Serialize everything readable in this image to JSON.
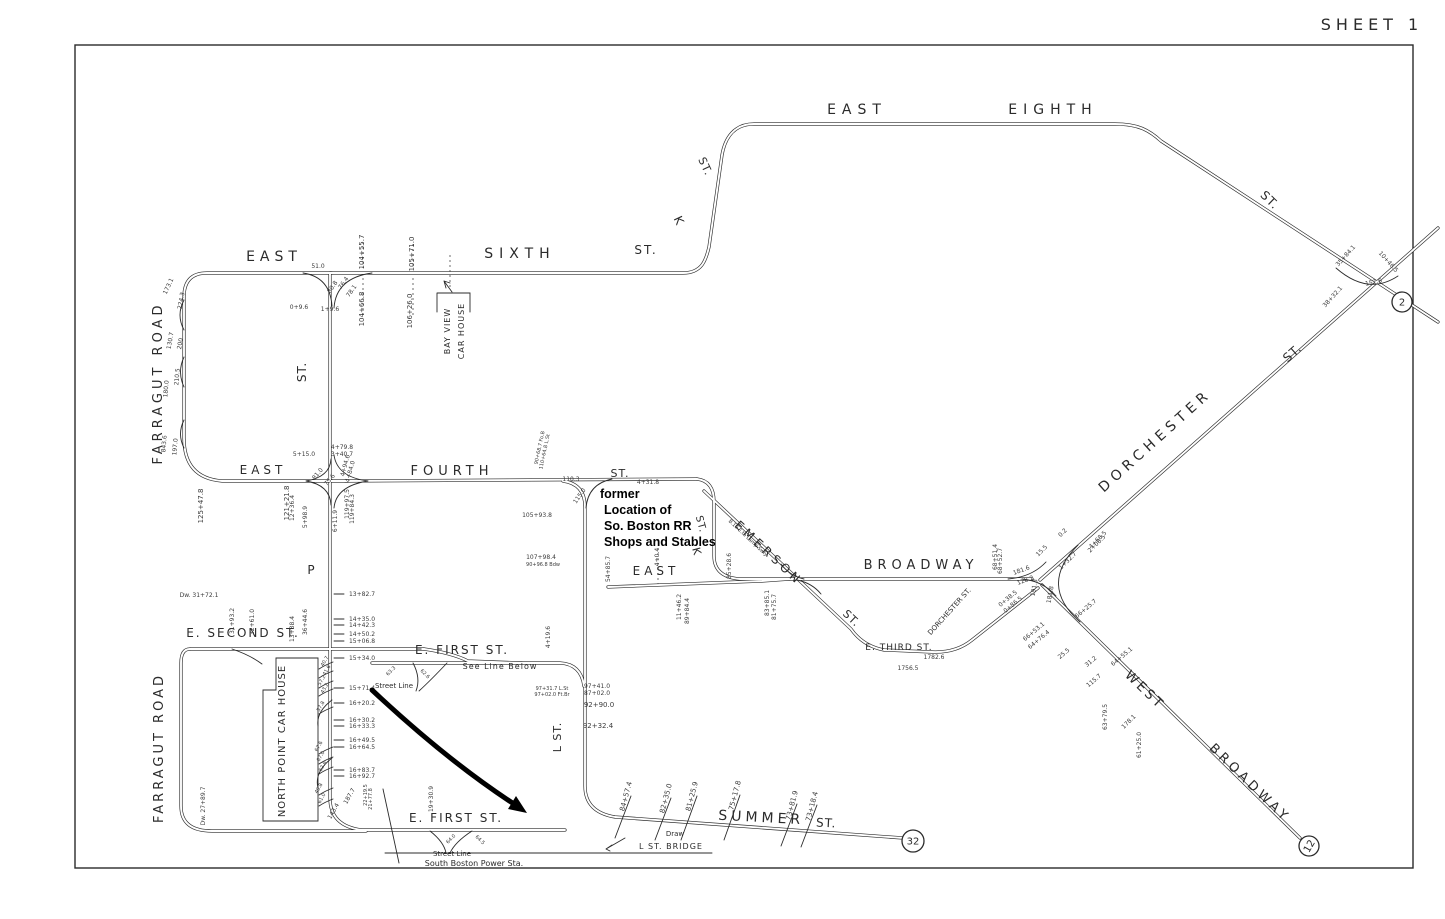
{
  "sheet": {
    "title": "SHEET 1"
  },
  "colors": {
    "ink": "#2b2b2b",
    "paper": "#ffffff",
    "annotation": "#000000"
  },
  "annotation": {
    "note_lines": [
      "former",
      "Location of",
      "So. Boston RR",
      "Shops and Stables"
    ]
  },
  "markers": [
    {
      "text": "2",
      "x": 1402,
      "y": 302,
      "r": 10
    },
    {
      "text": "32",
      "x": 913,
      "y": 841,
      "r": 11
    },
    {
      "text": "12",
      "x": 1309,
      "y": 846,
      "r": 10,
      "rot": -60
    }
  ],
  "street_labels": [
    {
      "text": "EAST",
      "x": 274,
      "y": 261,
      "rot": 0,
      "fs": 14,
      "ls": 5
    },
    {
      "text": "SIXTH",
      "x": 520,
      "y": 258,
      "rot": 0,
      "fs": 14,
      "ls": 6
    },
    {
      "text": "ST.",
      "x": 646,
      "y": 254,
      "rot": 0,
      "fs": 12,
      "ls": 2
    },
    {
      "text": "K",
      "x": 675,
      "y": 222,
      "rot": 65,
      "fs": 12,
      "ls": 0
    },
    {
      "text": "ST.",
      "x": 702,
      "y": 168,
      "rot": 65,
      "fs": 11,
      "ls": 1
    },
    {
      "text": "EAST",
      "x": 857,
      "y": 114,
      "rot": 0,
      "fs": 14,
      "ls": 6
    },
    {
      "text": "EIGHTH",
      "x": 1053,
      "y": 114,
      "rot": 0,
      "fs": 14,
      "ls": 6
    },
    {
      "text": "ST.",
      "x": 1267,
      "y": 203,
      "rot": 44,
      "fs": 12,
      "ls": 1
    },
    {
      "text": "DORCHESTER",
      "x": 1158,
      "y": 444,
      "rot": -42,
      "fs": 14,
      "ls": 5
    },
    {
      "text": "ST.",
      "x": 1295,
      "y": 356,
      "rot": -42,
      "fs": 12,
      "ls": 1
    },
    {
      "text": "BROADWAY",
      "x": 921,
      "y": 569,
      "rot": 0,
      "fs": 13,
      "ls": 5
    },
    {
      "text": "EAST",
      "x": 656,
      "y": 575,
      "rot": 0,
      "fs": 12,
      "ls": 4
    },
    {
      "text": "EMERSON",
      "x": 766,
      "y": 556,
      "rot": 43,
      "fs": 12,
      "ls": 4
    },
    {
      "text": "ST.",
      "x": 849,
      "y": 621,
      "rot": 43,
      "fs": 11,
      "ls": 1
    },
    {
      "text": "E. THIRD ST.",
      "x": 899,
      "y": 650,
      "rot": 0,
      "fs": 9,
      "ls": 1
    },
    {
      "text": "DORCHESTER ST.",
      "x": 951,
      "y": 613,
      "rot": -48,
      "fs": 7,
      "ls": 0
    },
    {
      "text": "WEST",
      "x": 1142,
      "y": 693,
      "rot": 44,
      "fs": 13,
      "ls": 3
    },
    {
      "text": "BROADWAY",
      "x": 1247,
      "y": 786,
      "rot": 44,
      "fs": 13,
      "ls": 4
    },
    {
      "text": "FOURTH",
      "x": 452,
      "y": 475,
      "rot": 0,
      "fs": 13,
      "ls": 5
    },
    {
      "text": "ST.",
      "x": 620,
      "y": 477,
      "rot": 0,
      "fs": 11,
      "ls": 1
    },
    {
      "text": "EAST",
      "x": 263,
      "y": 474,
      "rot": 0,
      "fs": 12,
      "ls": 4
    },
    {
      "text": "P",
      "x": 311,
      "y": 574,
      "rot": 0,
      "fs": 12,
      "ls": 0
    },
    {
      "text": "ST.",
      "x": 306,
      "y": 372,
      "rot": -90,
      "fs": 12,
      "ls": 1
    },
    {
      "text": "FARRAGUT ROAD",
      "x": 162,
      "y": 383,
      "rot": -90,
      "fs": 13,
      "ls": 4
    },
    {
      "text": "E. SECOND ST.",
      "x": 243,
      "y": 637,
      "rot": 0,
      "fs": 12,
      "ls": 2
    },
    {
      "text": "FARRAGUT ROAD",
      "x": 163,
      "y": 748,
      "rot": -90,
      "fs": 13,
      "ls": 3
    },
    {
      "text": "NORTH POINT CAR HOUSE",
      "x": 285,
      "y": 741,
      "rot": -90,
      "fs": 10,
      "ls": 1
    },
    {
      "text": "E. FIRST ST.",
      "x": 462,
      "y": 654,
      "rot": 0,
      "fs": 12,
      "ls": 2
    },
    {
      "text": "See Line Below",
      "x": 500,
      "y": 669,
      "rot": 0,
      "fs": 8,
      "ls": 1
    },
    {
      "text": "Street Line",
      "x": 394,
      "y": 688,
      "rot": 0,
      "fs": 7,
      "ls": 0
    },
    {
      "text": "L ST.",
      "x": 561,
      "y": 737,
      "rot": -90,
      "fs": 11,
      "ls": 1
    },
    {
      "text": "E. FIRST ST.",
      "x": 456,
      "y": 822,
      "rot": 0,
      "fs": 12,
      "ls": 2
    },
    {
      "text": "Street Line",
      "x": 452,
      "y": 856,
      "rot": 0,
      "fs": 7,
      "ls": 0
    },
    {
      "text": "South Boston Power Sta.",
      "x": 474,
      "y": 866,
      "rot": 0,
      "fs": 8,
      "ls": 0
    },
    {
      "text": "SUMMER",
      "x": 761,
      "y": 822,
      "rot": 3,
      "fs": 14,
      "ls": 4
    },
    {
      "text": "ST.",
      "x": 826,
      "y": 827,
      "rot": 3,
      "fs": 12,
      "ls": 1
    },
    {
      "text": "Draw",
      "x": 675,
      "y": 836,
      "rot": 0,
      "fs": 7,
      "ls": 0
    },
    {
      "text": "L ST. BRIDGE",
      "x": 671,
      "y": 849,
      "rot": 0,
      "fs": 8,
      "ls": 1
    },
    {
      "text": "BAY VIEW",
      "x": 450,
      "y": 331,
      "rot": -90,
      "fs": 8,
      "ls": 1
    },
    {
      "text": "CAR HOUSE",
      "x": 464,
      "y": 331,
      "rot": -90,
      "fs": 8,
      "ls": 1
    },
    {
      "text": "K",
      "x": 693,
      "y": 552,
      "rot": 75,
      "fs": 11,
      "ls": 0
    },
    {
      "text": "ST.",
      "x": 698,
      "y": 525,
      "rot": 75,
      "fs": 10,
      "ls": 1
    },
    {
      "text": "B.19 E.to Lamp Swly",
      "x": 747,
      "y": 539,
      "rot": 43,
      "fs": 5,
      "ls": 0
    }
  ],
  "measurements": [
    {
      "text": "51.0",
      "x": 318,
      "y": 268,
      "rot": 0,
      "fs": 6
    },
    {
      "text": "104+55.7",
      "x": 364,
      "y": 252,
      "rot": -90
    },
    {
      "text": "105+71.0",
      "x": 414,
      "y": 254,
      "rot": -90
    },
    {
      "text": "104+66.8",
      "x": 364,
      "y": 309,
      "rot": -90
    },
    {
      "text": "106+26.0",
      "x": 412,
      "y": 311,
      "rot": -90
    },
    {
      "text": "0+9.6",
      "x": 299,
      "y": 309,
      "rot": 0,
      "fs": 6
    },
    {
      "text": "1+9.6",
      "x": 330,
      "y": 311,
      "rot": 0,
      "fs": 6
    },
    {
      "text": "80.8",
      "x": 334,
      "y": 288,
      "rot": -55,
      "fs": 6
    },
    {
      "text": "76.4",
      "x": 345,
      "y": 284,
      "rot": -55,
      "fs": 6
    },
    {
      "text": "78.1",
      "x": 353,
      "y": 292,
      "rot": -55,
      "fs": 6
    },
    {
      "text": "173.1",
      "x": 170,
      "y": 287,
      "rot": -65,
      "fs": 6
    },
    {
      "text": "224.3",
      "x": 183,
      "y": 301,
      "rot": -80,
      "fs": 6
    },
    {
      "text": "130.7",
      "x": 172,
      "y": 341,
      "rot": -80,
      "fs": 6
    },
    {
      "text": "200",
      "x": 182,
      "y": 344,
      "rot": -80,
      "fs": 6
    },
    {
      "text": "210.5",
      "x": 179,
      "y": 377,
      "rot": -85,
      "fs": 6
    },
    {
      "text": "180.0",
      "x": 168,
      "y": 389,
      "rot": -85,
      "fs": 6
    },
    {
      "text": "843.6",
      "x": 166,
      "y": 444,
      "rot": -85,
      "fs": 6
    },
    {
      "text": "197.0",
      "x": 177,
      "y": 447,
      "rot": -85,
      "fs": 6
    },
    {
      "text": "125+47.8",
      "x": 203,
      "y": 506,
      "rot": -90
    },
    {
      "text": "5+15.0",
      "x": 304,
      "y": 456,
      "rot": 0,
      "fs": 6
    },
    {
      "text": "4+79.8",
      "x": 342,
      "y": 449,
      "rot": 0,
      "fs": 6
    },
    {
      "text": "3+40.7",
      "x": 342,
      "y": 456,
      "rot": 0,
      "fs": 6
    },
    {
      "text": "81.0",
      "x": 319,
      "y": 475,
      "rot": -50,
      "fs": 6
    },
    {
      "text": "75.6",
      "x": 331,
      "y": 481,
      "rot": -50,
      "fs": 6
    },
    {
      "text": "4+94.6",
      "x": 347,
      "y": 466,
      "rot": -75,
      "fs": 6
    },
    {
      "text": "4+84.0",
      "x": 352,
      "y": 472,
      "rot": -75,
      "fs": 6
    },
    {
      "text": "121+21.8",
      "x": 289,
      "y": 503,
      "rot": -90
    },
    {
      "text": "12+36.4",
      "x": 294,
      "y": 508,
      "rot": -90,
      "fs": 6
    },
    {
      "text": "5+98.9",
      "x": 307,
      "y": 517,
      "rot": -90,
      "fs": 6
    },
    {
      "text": "6+11.9",
      "x": 337,
      "y": 521,
      "rot": -90,
      "fs": 6
    },
    {
      "text": "119+97.5",
      "x": 349,
      "y": 504,
      "rot": -90,
      "fs": 6
    },
    {
      "text": "119+84.3",
      "x": 354,
      "y": 509,
      "rot": -90,
      "fs": 6
    },
    {
      "text": "90+68.7 Fo.B",
      "x": 541,
      "y": 448,
      "rot": -78,
      "fs": 5
    },
    {
      "text": "110+64.8 L.St",
      "x": 546,
      "y": 452,
      "rot": -78,
      "fs": 5
    },
    {
      "text": "110.3",
      "x": 571,
      "y": 481,
      "rot": 0,
      "fs": 6
    },
    {
      "text": "4+31.8",
      "x": 648,
      "y": 484,
      "rot": 0,
      "fs": 6
    },
    {
      "text": "115.0",
      "x": 581,
      "y": 497,
      "rot": -55,
      "fs": 6
    },
    {
      "text": "105+93.8",
      "x": 537,
      "y": 517,
      "rot": 0,
      "fs": 6
    },
    {
      "text": "107+98.4",
      "x": 541,
      "y": 559,
      "rot": 0,
      "fs": 6
    },
    {
      "text": "90+96.8 Bdw",
      "x": 543,
      "y": 566,
      "rot": 0,
      "fs": 5
    },
    {
      "text": "54+85.7",
      "x": 610,
      "y": 569,
      "rot": -90,
      "fs": 6
    },
    {
      "text": "4+0.4",
      "x": 659,
      "y": 557,
      "rot": -90,
      "fs": 6
    },
    {
      "text": "85+28.6",
      "x": 731,
      "y": 566,
      "rot": -90,
      "fs": 6
    },
    {
      "text": "11+46.2",
      "x": 681,
      "y": 607,
      "rot": -90,
      "fs": 6
    },
    {
      "text": "89+84.4",
      "x": 689,
      "y": 611,
      "rot": -90,
      "fs": 6
    },
    {
      "text": "83+85.1",
      "x": 769,
      "y": 603,
      "rot": -90,
      "fs": 6
    },
    {
      "text": "81+75.7",
      "x": 776,
      "y": 607,
      "rot": -90,
      "fs": 6
    },
    {
      "text": "68+51.4",
      "x": 997,
      "y": 557,
      "rot": -90,
      "fs": 6
    },
    {
      "text": "68+52.7",
      "x": 1002,
      "y": 561,
      "rot": -90,
      "fs": 6
    },
    {
      "text": "181.6",
      "x": 1022,
      "y": 572,
      "rot": -20,
      "fs": 6
    },
    {
      "text": "128.2",
      "x": 1026,
      "y": 582,
      "rot": -20,
      "fs": 6
    },
    {
      "text": "191.3",
      "x": 1036,
      "y": 588,
      "rot": -80,
      "fs": 6
    },
    {
      "text": "181.8",
      "x": 1052,
      "y": 595,
      "rot": -80,
      "fs": 6
    },
    {
      "text": "0.2",
      "x": 1064,
      "y": 534,
      "rot": -45,
      "fs": 6
    },
    {
      "text": "1+32.7",
      "x": 1069,
      "y": 562,
      "rot": -45,
      "fs": 6
    },
    {
      "text": "2+08.5",
      "x": 1098,
      "y": 545,
      "rot": -45,
      "fs": 6
    },
    {
      "text": "15.5",
      "x": 1043,
      "y": 552,
      "rot": -45,
      "fs": 6
    },
    {
      "text": "4+68.5",
      "x": 1099,
      "y": 541,
      "rot": -45,
      "fs": 6
    },
    {
      "text": "0+38.5",
      "x": 1009,
      "y": 600,
      "rot": -40,
      "fs": 6
    },
    {
      "text": "0+86.5",
      "x": 1014,
      "y": 606,
      "rot": -40,
      "fs": 6
    },
    {
      "text": "66+25.7",
      "x": 1087,
      "y": 610,
      "rot": -40,
      "fs": 6
    },
    {
      "text": "66+53.1",
      "x": 1035,
      "y": 633,
      "rot": -40,
      "fs": 6
    },
    {
      "text": "64+76.4",
      "x": 1040,
      "y": 641,
      "rot": -40,
      "fs": 6
    },
    {
      "text": "64+55.1",
      "x": 1123,
      "y": 658,
      "rot": -40,
      "fs": 6
    },
    {
      "text": "25.5",
      "x": 1065,
      "y": 655,
      "rot": -40,
      "fs": 6
    },
    {
      "text": "31.2",
      "x": 1092,
      "y": 663,
      "rot": -40,
      "fs": 6
    },
    {
      "text": "115.7",
      "x": 1095,
      "y": 682,
      "rot": -40,
      "fs": 6
    },
    {
      "text": "63+79.5",
      "x": 1107,
      "y": 717,
      "rot": -90,
      "fs": 6
    },
    {
      "text": "178.1",
      "x": 1130,
      "y": 723,
      "rot": -45,
      "fs": 6
    },
    {
      "text": "61+25.0",
      "x": 1141,
      "y": 745,
      "rot": -90,
      "fs": 6
    },
    {
      "text": "35+84.1",
      "x": 1347,
      "y": 257,
      "rot": -48,
      "fs": 6
    },
    {
      "text": "10+46.5",
      "x": 1387,
      "y": 263,
      "rot": 48,
      "fs": 6
    },
    {
      "text": "152.6",
      "x": 1374,
      "y": 284,
      "rot": -12,
      "fs": 6
    },
    {
      "text": "38+32.1",
      "x": 1334,
      "y": 298,
      "rot": -48,
      "fs": 6
    },
    {
      "text": "1782.6",
      "x": 934,
      "y": 659,
      "rot": 0,
      "fs": 6
    },
    {
      "text": "1756.5",
      "x": 908,
      "y": 670,
      "rot": 0,
      "fs": 6
    },
    {
      "text": "Dw. 31+72.1",
      "x": 199,
      "y": 597,
      "rot": 0,
      "fs": 6
    },
    {
      "text": "31+93.2",
      "x": 234,
      "y": 621,
      "rot": -90,
      "fs": 6
    },
    {
      "text": "32+61.0",
      "x": 254,
      "y": 622,
      "rot": -90,
      "fs": 6
    },
    {
      "text": "13+38.4",
      "x": 294,
      "y": 629,
      "rot": -90,
      "fs": 6
    },
    {
      "text": "36+44.6",
      "x": 307,
      "y": 622,
      "rot": -90,
      "fs": 6
    },
    {
      "text": "13+82.7",
      "x": 362,
      "y": 596,
      "rot": 0,
      "fs": 6
    },
    {
      "text": "14+35.0",
      "x": 362,
      "y": 621,
      "rot": 0,
      "fs": 6
    },
    {
      "text": "14+42.3",
      "x": 362,
      "y": 627,
      "rot": 0,
      "fs": 6
    },
    {
      "text": "14+50.2",
      "x": 362,
      "y": 636,
      "rot": 0,
      "fs": 6
    },
    {
      "text": "15+06.8",
      "x": 362,
      "y": 643,
      "rot": 0,
      "fs": 6
    },
    {
      "text": "15+34.0",
      "x": 362,
      "y": 660,
      "rot": 0,
      "fs": 6
    },
    {
      "text": "15+71.4",
      "x": 362,
      "y": 690,
      "rot": 0,
      "fs": 6
    },
    {
      "text": "16+20.2",
      "x": 362,
      "y": 705,
      "rot": 0,
      "fs": 6
    },
    {
      "text": "16+30.2",
      "x": 362,
      "y": 722,
      "rot": 0,
      "fs": 6
    },
    {
      "text": "16+33.3",
      "x": 362,
      "y": 728,
      "rot": 0,
      "fs": 6
    },
    {
      "text": "16+49.5",
      "x": 362,
      "y": 742,
      "rot": 0,
      "fs": 6
    },
    {
      "text": "16+64.5",
      "x": 362,
      "y": 749,
      "rot": 0,
      "fs": 6
    },
    {
      "text": "16+83.7",
      "x": 362,
      "y": 772,
      "rot": 0,
      "fs": 6
    },
    {
      "text": "16+92.7",
      "x": 362,
      "y": 778,
      "rot": 0,
      "fs": 6
    },
    {
      "text": "40.7",
      "x": 326,
      "y": 662,
      "rot": -60,
      "fs": 5
    },
    {
      "text": "41.6",
      "x": 328,
      "y": 671,
      "rot": -60,
      "fs": 5
    },
    {
      "text": "57.2",
      "x": 323,
      "y": 681,
      "rot": -60,
      "fs": 5
    },
    {
      "text": "43.2",
      "x": 326,
      "y": 689,
      "rot": -60,
      "fs": 5
    },
    {
      "text": "57.8",
      "x": 322,
      "y": 707,
      "rot": -60,
      "fs": 5
    },
    {
      "text": "67.6",
      "x": 320,
      "y": 747,
      "rot": -60,
      "fs": 5
    },
    {
      "text": "67.0",
      "x": 322,
      "y": 757,
      "rot": -60,
      "fs": 5
    },
    {
      "text": "62.6",
      "x": 324,
      "y": 767,
      "rot": -60,
      "fs": 5
    },
    {
      "text": "49.8",
      "x": 320,
      "y": 789,
      "rot": -60,
      "fs": 5
    },
    {
      "text": "61.0",
      "x": 323,
      "y": 799,
      "rot": -60,
      "fs": 5
    },
    {
      "text": "143.4",
      "x": 335,
      "y": 812,
      "rot": -60,
      "fs": 6
    },
    {
      "text": "187.7",
      "x": 351,
      "y": 797,
      "rot": -60,
      "fs": 6
    },
    {
      "text": "Dw. 27+89.7",
      "x": 205,
      "y": 806,
      "rot": -90,
      "fs": 6
    },
    {
      "text": "22+19.5",
      "x": 367,
      "y": 795,
      "rot": -90,
      "fs": 5
    },
    {
      "text": "21+77.8",
      "x": 372,
      "y": 799,
      "rot": -90,
      "fs": 5
    },
    {
      "text": "19+30.9",
      "x": 433,
      "y": 799,
      "rot": -90,
      "fs": 6
    },
    {
      "text": "64.0",
      "x": 452,
      "y": 840,
      "rot": -45,
      "fs": 5
    },
    {
      "text": "64.5",
      "x": 479,
      "y": 841,
      "rot": 45,
      "fs": 5
    },
    {
      "text": "63.3",
      "x": 392,
      "y": 672,
      "rot": -45,
      "fs": 5
    },
    {
      "text": "62.6",
      "x": 424,
      "y": 675,
      "rot": 45,
      "fs": 5
    },
    {
      "text": "4+19.6",
      "x": 550,
      "y": 637,
      "rot": -90,
      "fs": 6
    },
    {
      "text": "97+31.7 L.St",
      "x": 552,
      "y": 690,
      "rot": 0,
      "fs": 5
    },
    {
      "text": "97+02.0 Ft.Br",
      "x": 552,
      "y": 696,
      "rot": 0,
      "fs": 5
    },
    {
      "text": "97+41.0",
      "x": 597,
      "y": 688,
      "rot": 0,
      "fs": 6
    },
    {
      "text": "87+02.0",
      "x": 597,
      "y": 695,
      "rot": 0,
      "fs": 6
    },
    {
      "text": "92+90.0",
      "x": 599,
      "y": 707,
      "rot": 0
    },
    {
      "text": "92+32.4",
      "x": 598,
      "y": 728,
      "rot": 0
    },
    {
      "text": "84+57.4",
      "x": 628,
      "y": 797,
      "rot": -75
    },
    {
      "text": "82+35.0",
      "x": 668,
      "y": 799,
      "rot": -75
    },
    {
      "text": "81+25.9",
      "x": 694,
      "y": 797,
      "rot": -75
    },
    {
      "text": "75+17.8",
      "x": 737,
      "y": 796,
      "rot": -75
    },
    {
      "text": "73+81.9",
      "x": 794,
      "y": 806,
      "rot": -75
    },
    {
      "text": "73+18.4",
      "x": 814,
      "y": 807,
      "rot": -75
    }
  ]
}
